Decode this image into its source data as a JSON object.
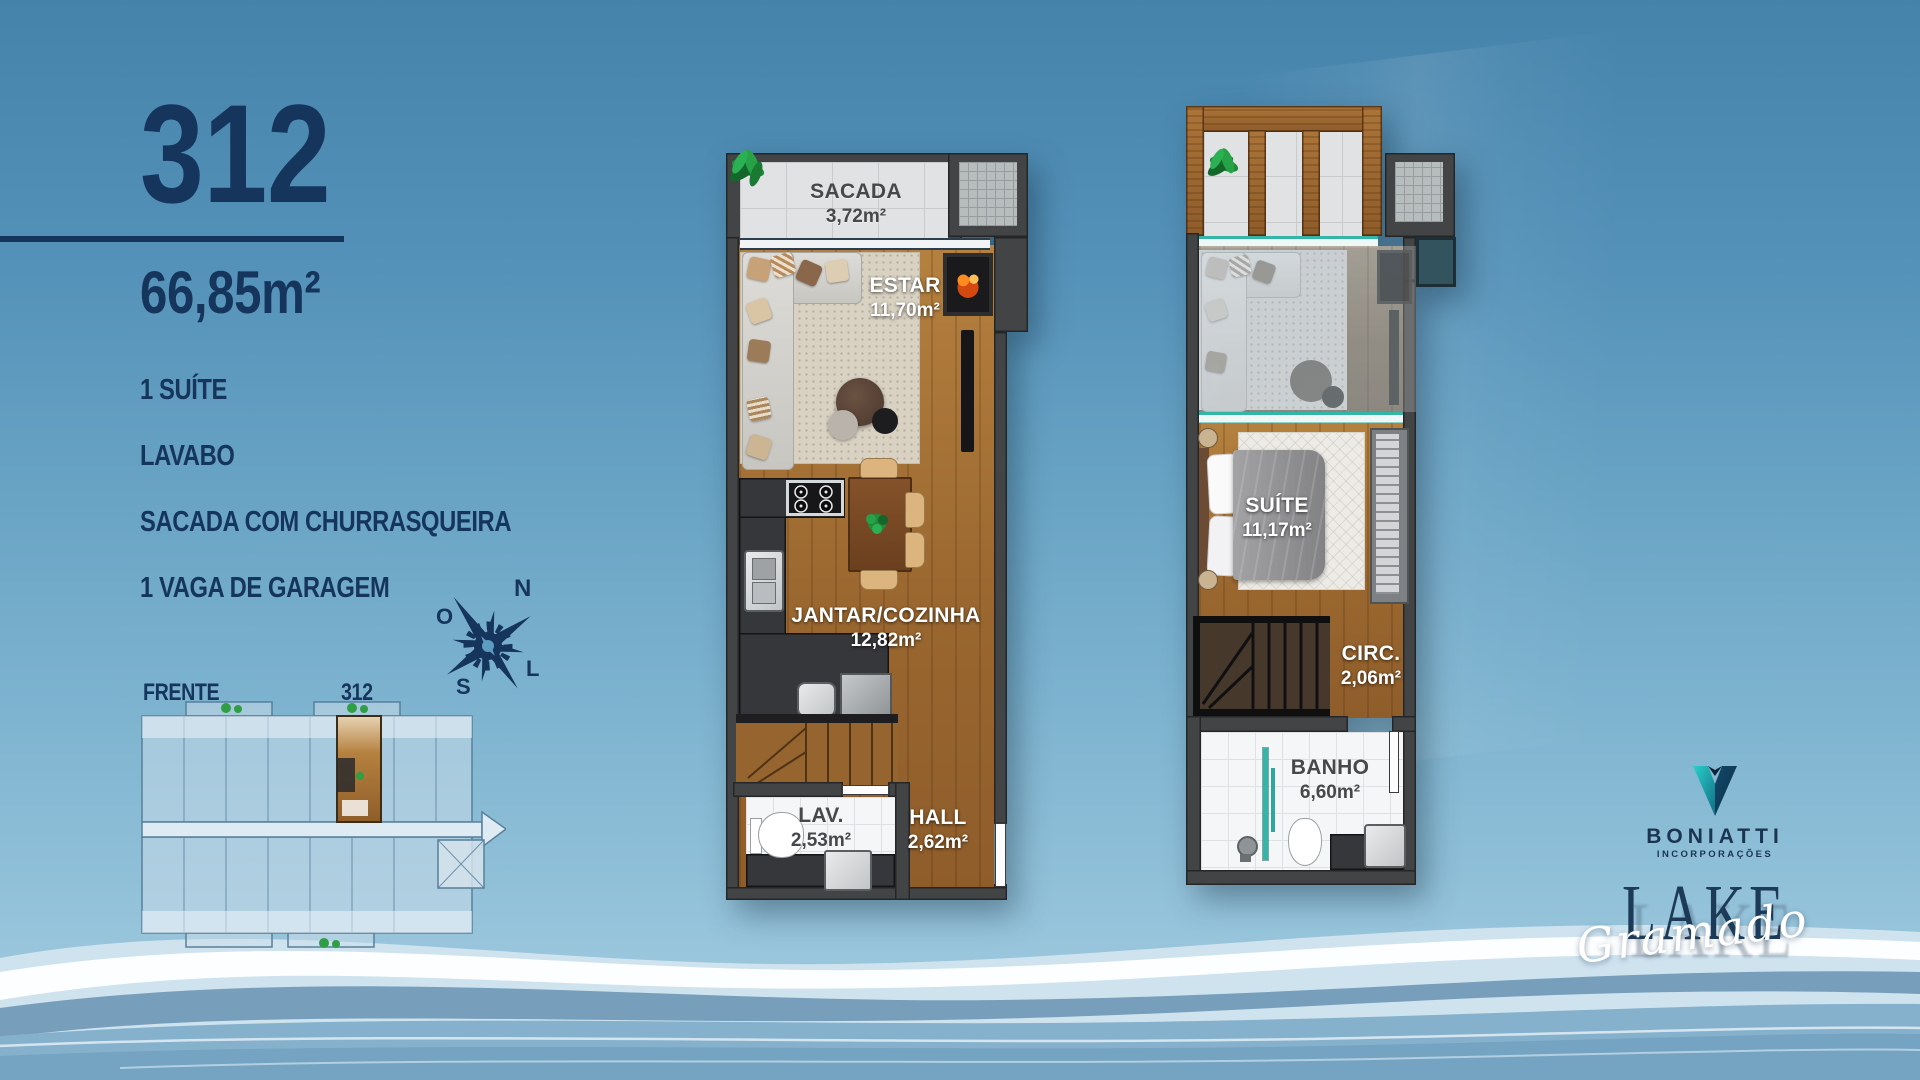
{
  "panel": {
    "unit_number": "312",
    "area": "66,85m²",
    "features": [
      "1 SUÍTE",
      "LAVABO",
      "SACADA COM CHURRASQUEIRA",
      "1 VAGA DE GARAGEM"
    ],
    "front_label": "FRENTE",
    "keyplan_unit_label": "312"
  },
  "compass": {
    "north": "N",
    "south": "S",
    "west": "O",
    "east": "L"
  },
  "floor1": {
    "rooms": [
      {
        "id": "sacada",
        "name": "SACADA",
        "area": "3,72m²"
      },
      {
        "id": "estar",
        "name": "ESTAR",
        "area": "11,70m²"
      },
      {
        "id": "jantar-cozinha",
        "name": "JANTAR/COZINHA",
        "area": "12,82m²"
      },
      {
        "id": "lavabo",
        "name": "LAV.",
        "area": "2,53m²"
      },
      {
        "id": "hall",
        "name": "HALL",
        "area": "2,62m²"
      }
    ]
  },
  "floor2": {
    "rooms": [
      {
        "id": "suite",
        "name": "SUÍTE",
        "area": "11,17m²"
      },
      {
        "id": "circulacao",
        "name": "CIRC.",
        "area": "2,06m²"
      },
      {
        "id": "banho",
        "name": "BANHO",
        "area": "6,60m²"
      }
    ]
  },
  "branding": {
    "developer": "BONIATTI",
    "developer_subtitle": "INCORPORAÇÕES",
    "project_name": "LAKE",
    "project_script": "Gramado"
  },
  "colors": {
    "navy": "#16355c",
    "background_top": "#4583ab",
    "background_bottom": "#a9cfe1",
    "wall": "#434446",
    "wood": "#a9743f",
    "teal_glass": "#35b4a8",
    "logo_teal": "#28c4c0"
  }
}
